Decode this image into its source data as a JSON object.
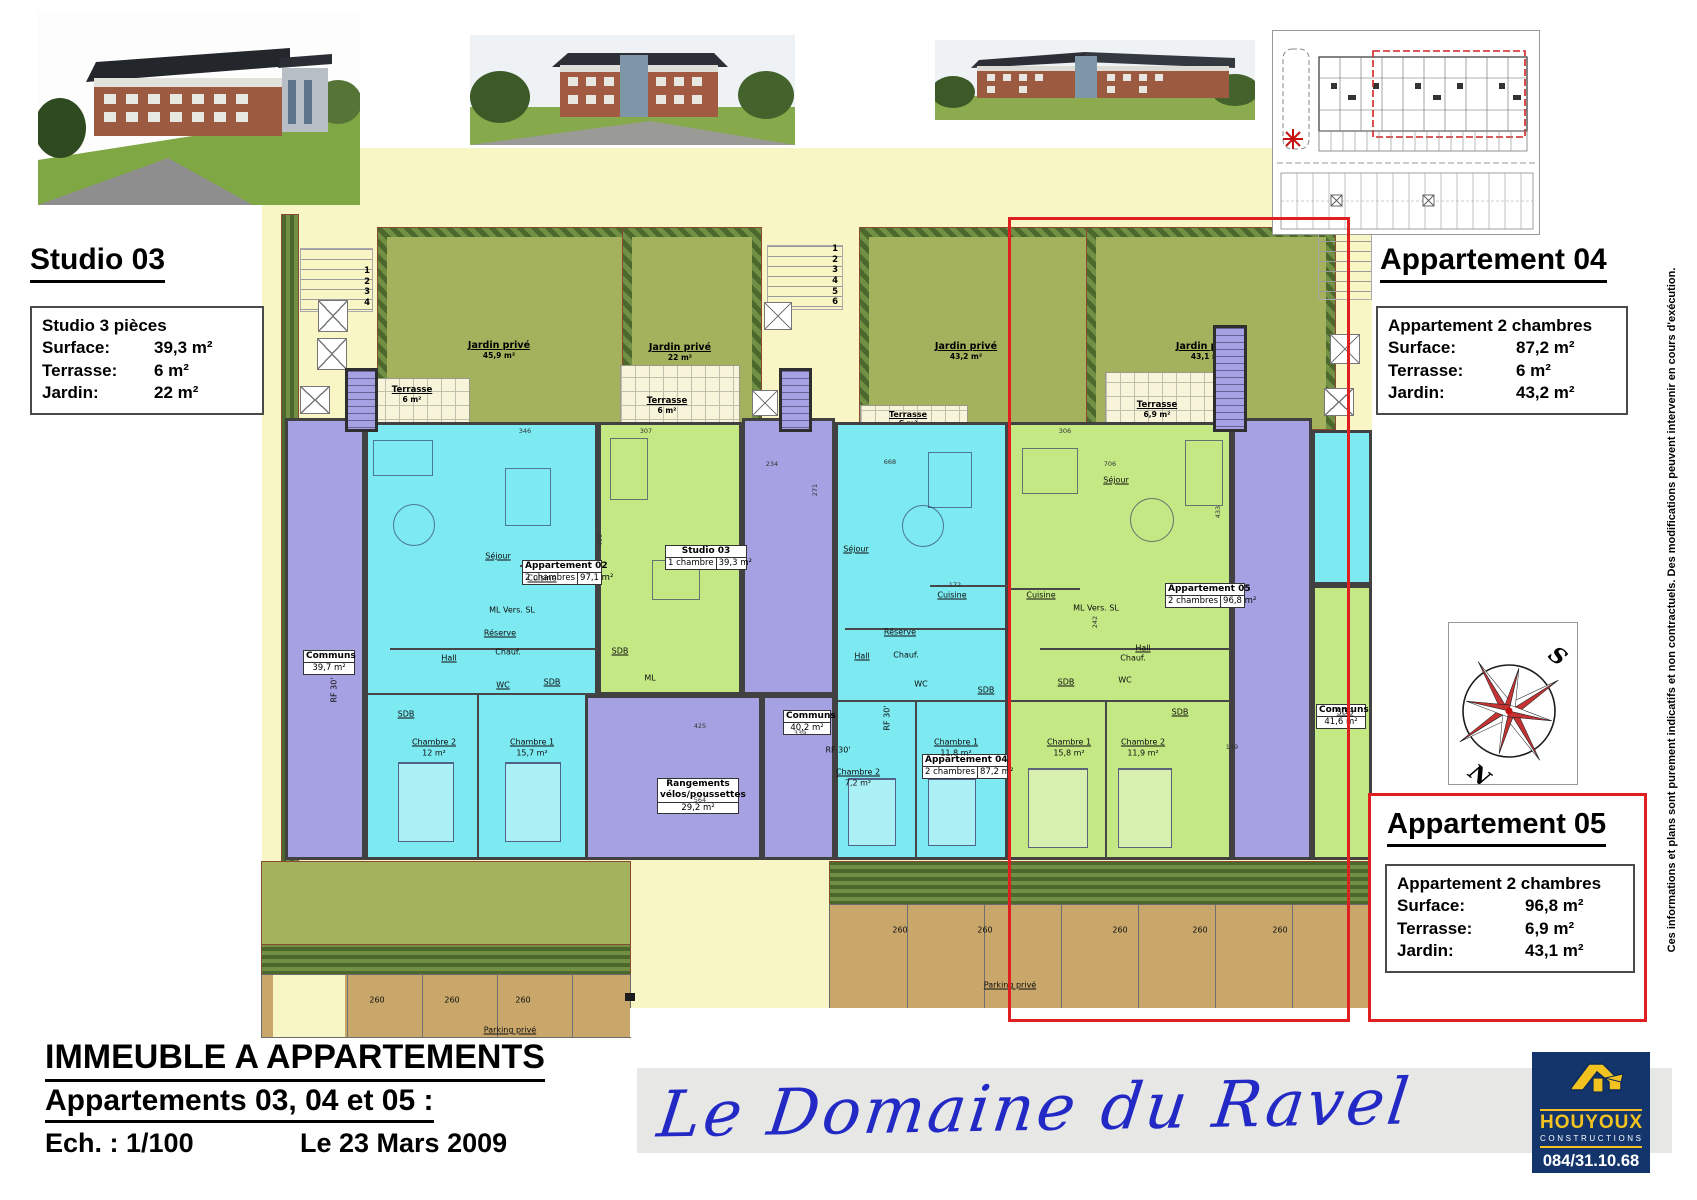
{
  "info_studio03": {
    "title": "Studio 03",
    "box_title": "Studio 3 pièces",
    "rows": [
      {
        "label": "Surface:",
        "value": "39,3 m²"
      },
      {
        "label": "Terrasse:",
        "value": "6 m²"
      },
      {
        "label": "Jardin:",
        "value": "22 m²"
      }
    ]
  },
  "info_apt04": {
    "title": "Appartement 04",
    "box_title": "Appartement 2 chambres",
    "rows": [
      {
        "label": "Surface:",
        "value": "87,2 m²"
      },
      {
        "label": "Terrasse:",
        "value": "6 m²"
      },
      {
        "label": "Jardin:",
        "value": "43,2 m²"
      }
    ]
  },
  "info_apt05": {
    "title": "Appartement 05",
    "box_title": "Appartement 2 chambres",
    "rows": [
      {
        "label": "Surface:",
        "value": "96,8 m²"
      },
      {
        "label": "Terrasse:",
        "value": "6,9 m²"
      },
      {
        "label": "Jardin:",
        "value": "43,1 m²"
      }
    ]
  },
  "title_block": {
    "line1": "IMMEUBLE A APPARTEMENTS",
    "line2": "Appartements 03, 04 et 05 :",
    "scale": "Ech. : 1/100",
    "date": "Le 23 Mars 2009"
  },
  "banner": {
    "script": "Le Domaine du Ravel"
  },
  "logo": {
    "name": "HOUYOUX",
    "subtitle": "CONSTRUCTIONS",
    "phone": "084/31.10.68"
  },
  "disclaimer": "Ces informations et plans sont purement indicatifs et non contractuels.  Des modifications peuvent intervenir en cours d'exécution.",
  "compass": {
    "s": "S",
    "n": "N"
  },
  "colors": {
    "accent_red": "#e02020",
    "canvas": "#f8f6c4",
    "cyan": "#7de9f0",
    "green_unit": "#c3e884",
    "purple": "#a6a1e2",
    "garden": "#a4b15d",
    "parking_tan": "#c9a76b",
    "navy": "#14356b",
    "yellow": "#f2c320",
    "script_blue": "#2329c4"
  },
  "plan": {
    "gardens": [
      {
        "name": "Jardin privé",
        "area": "45,9 m²"
      },
      {
        "name": "Jardin privé",
        "area": "22 m²"
      },
      {
        "name": "Jardin privé",
        "area": "43,2 m²"
      },
      {
        "name": "Jardin privé",
        "area": "43,1 m²"
      }
    ],
    "terraces": [
      {
        "name": "Terrasse",
        "area": "6 m²"
      },
      {
        "name": "Terrasse",
        "area": "6 m²"
      },
      {
        "name": "Terrasse",
        "area": "6 m²"
      },
      {
        "name": "Terrasse",
        "area": "6,9 m²"
      }
    ],
    "steps_left": [
      "1",
      "2",
      "3",
      "4"
    ],
    "steps_mid": [
      "1",
      "2",
      "3",
      "4",
      "5",
      "6"
    ],
    "units": [
      {
        "name": "Appartement 02",
        "sub": "2 chambres",
        "area": "97,1 m²"
      },
      {
        "name": "Studio 03",
        "sub": "1 chambre",
        "area": "39,3 m²"
      },
      {
        "name": "Appartement 04",
        "sub": "2 chambres",
        "area": "87,2 m²"
      },
      {
        "name": "Appartement 05",
        "sub": "2 chambres",
        "area": "96,8 m²"
      }
    ],
    "communs": [
      {
        "name": "Communs",
        "area": "39,7 m²"
      },
      {
        "name": "Communs",
        "area": "40,2 m²"
      },
      {
        "name": "Communs",
        "area": "41,6 m²"
      }
    ],
    "rangements": {
      "line1": "Rangements",
      "line2": "vélos/poussettes",
      "area": "29,2 m²"
    },
    "rooms": [
      {
        "t": "Séjour"
      },
      {
        "t": "Cuisine"
      },
      {
        "t": "ML  Vers. SL"
      },
      {
        "t": "Réserve"
      },
      {
        "t": "Chauf."
      },
      {
        "t": "Hall"
      },
      {
        "t": "WC"
      },
      {
        "t": "SDB"
      },
      {
        "t": "SDB"
      },
      {
        "t": "Chambre 2"
      },
      {
        "t": "12 m²"
      },
      {
        "t": "Chambre 1"
      },
      {
        "t": "15,7 m²"
      },
      {
        "t": "SDB"
      },
      {
        "t": "ML"
      },
      {
        "t": "Séjour"
      },
      {
        "t": "Cuisine"
      },
      {
        "t": "Réserve"
      },
      {
        "t": "Chauf."
      },
      {
        "t": "Hall"
      },
      {
        "t": "WC"
      },
      {
        "t": "SDB"
      },
      {
        "t": "Chambre 1"
      },
      {
        "t": "11,8 m²"
      },
      {
        "t": "Chambre 2"
      },
      {
        "t": "7,2 m²"
      },
      {
        "t": "Séjour"
      },
      {
        "t": "Cuisine"
      },
      {
        "t": "ML  Vers. SL"
      },
      {
        "t": "Chauf."
      },
      {
        "t": "Hall"
      },
      {
        "t": "WC"
      },
      {
        "t": "SDB"
      },
      {
        "t": "SDB"
      },
      {
        "t": "Chambre 1"
      },
      {
        "t": "15,8 m²"
      },
      {
        "t": "Chambre 2"
      },
      {
        "t": "11,9 m²"
      },
      {
        "t": "SDB"
      }
    ],
    "rf": "RF 30'",
    "parking_label": "Parking privé",
    "space_num": "260",
    "dims": [
      "346",
      "307",
      "234",
      "668",
      "306",
      "706",
      "271",
      "499",
      "433",
      "425",
      "564",
      "339",
      "149",
      "242",
      "172"
    ]
  }
}
